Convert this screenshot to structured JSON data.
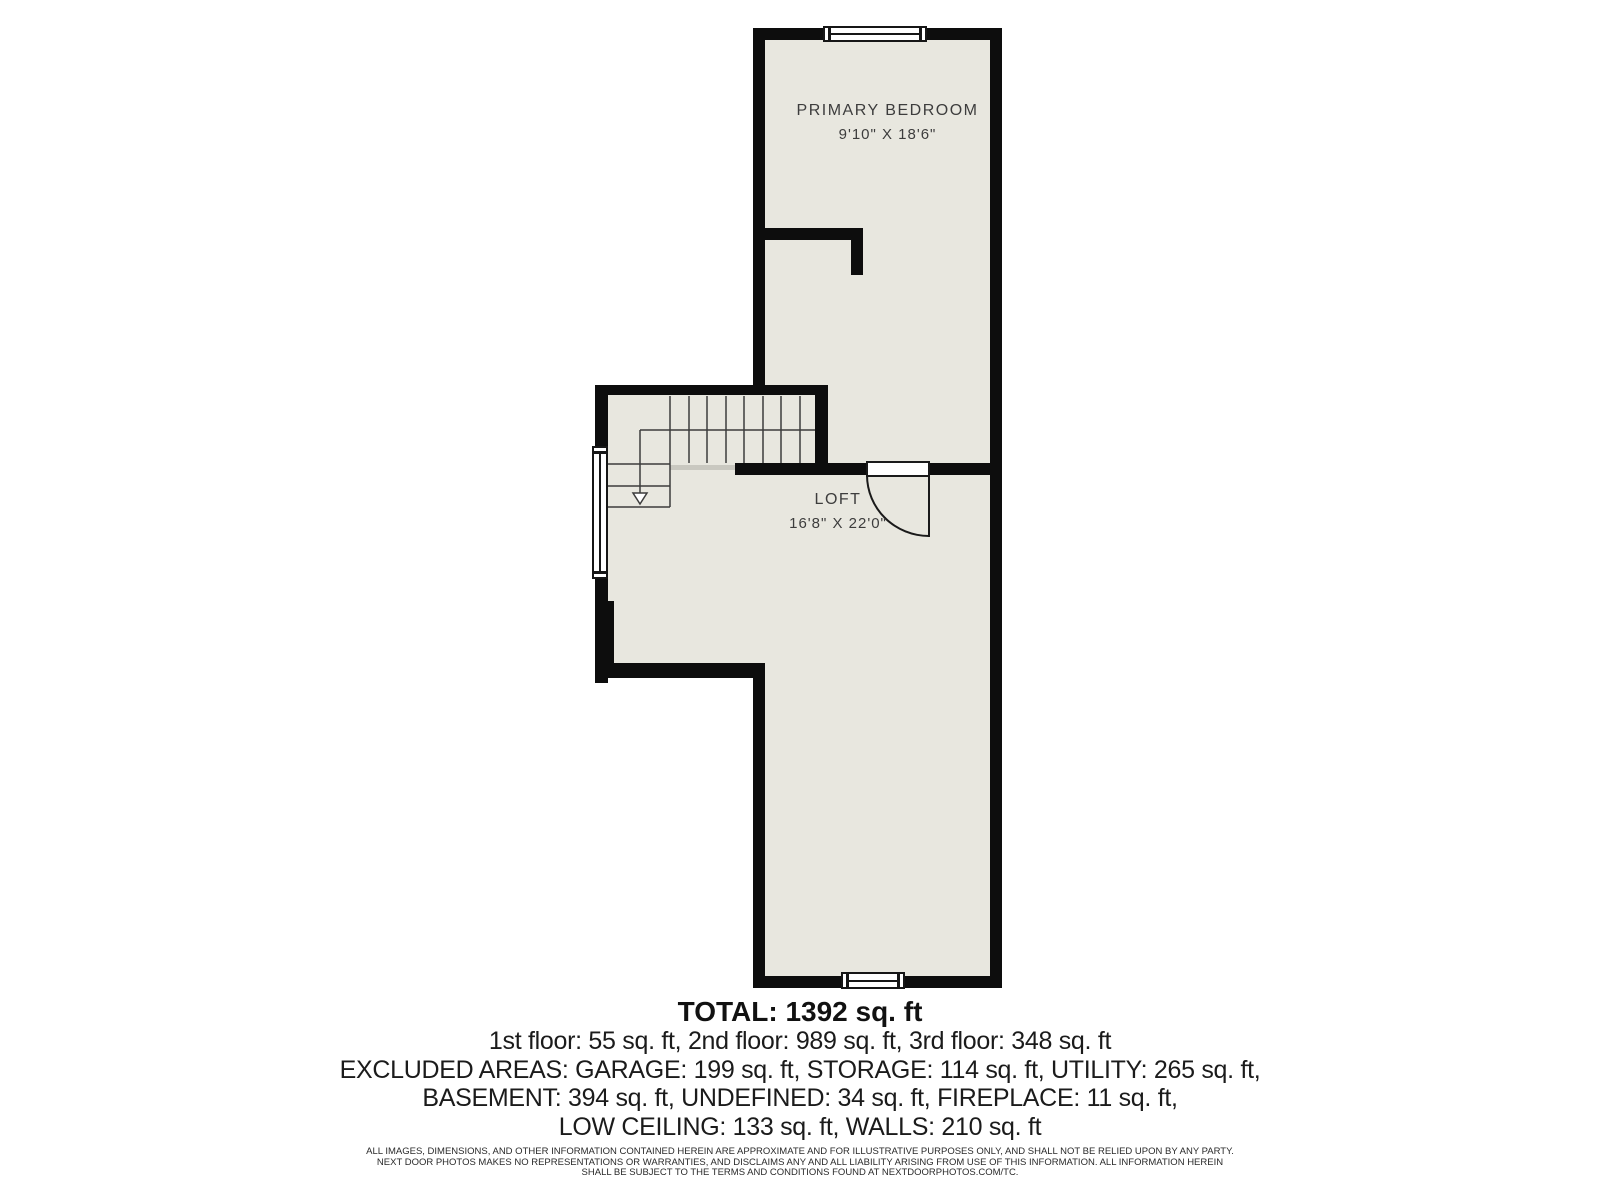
{
  "document": {
    "type": "floor-plan"
  },
  "rooms": [
    {
      "name": "PRIMARY BEDROOM",
      "dimensions": "9'10\" X 18'6\""
    },
    {
      "name": "LOFT",
      "dimensions": "16'8\" X 22'0\""
    }
  ],
  "summary": {
    "total": "TOTAL: 1392 sq. ft",
    "floors": "1st floor: 55 sq. ft, 2nd floor: 989 sq. ft, 3rd floor: 348 sq. ft",
    "excluded_1": "EXCLUDED AREAS: GARAGE: 199 sq. ft, STORAGE: 114 sq. ft, UTILITY: 265 sq. ft,",
    "excluded_2": "BASEMENT: 394 sq. ft, UNDEFINED: 34 sq. ft, FIREPLACE: 11 sq. ft,",
    "excluded_3": "LOW CEILING: 133 sq. ft, WALLS: 210 sq. ft"
  },
  "disclaimer": {
    "line1": "ALL IMAGES, DIMENSIONS, AND OTHER INFORMATION CONTAINED HEREIN ARE APPROXIMATE AND FOR ILLUSTRATIVE PURPOSES ONLY, AND SHALL NOT BE RELIED UPON BY ANY PARTY.",
    "line2": "NEXT DOOR PHOTOS MAKES NO REPRESENTATIONS OR WARRANTIES, AND DISCLAIMS ANY AND ALL LIABILITY ARISING FROM USE OF THIS INFORMATION. ALL INFORMATION HEREIN",
    "line3": "SHALL BE SUBJECT TO THE TERMS AND CONDITIONS FOUND AT NEXTDOORPHOTOS.COM/TC."
  },
  "colors": {
    "floor": "#e8e7df",
    "wall": "#0d0d0d",
    "window": "#ffffff",
    "stair_line": "#3c3c3c",
    "label_text": "#3d3d3d",
    "summary_text": "#1b1b1b"
  }
}
